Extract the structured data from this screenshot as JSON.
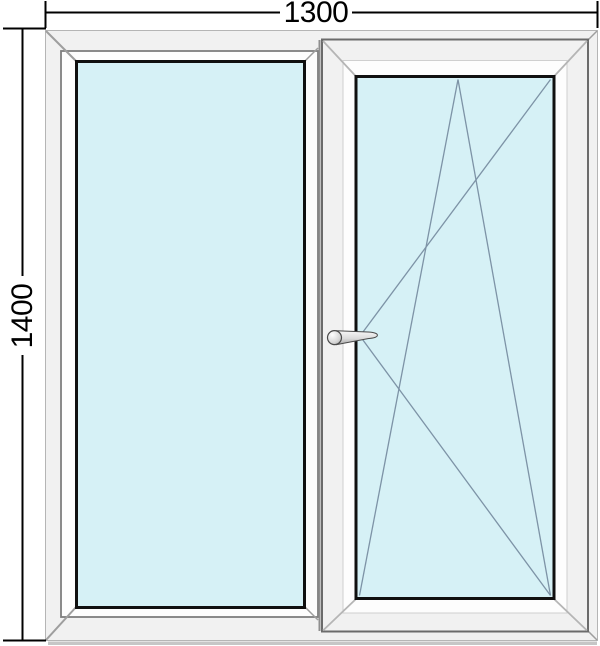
{
  "figure": {
    "type": "window-technical-drawing",
    "description": "Two-section PVC window: left fixed glazed pane, right tilt-and-turn sash with handle",
    "dimensions": {
      "width_label": "1300",
      "height_label": "1400"
    },
    "panels": [
      {
        "name": "left-pane",
        "glazing": "fixed",
        "opening": "none"
      },
      {
        "name": "right-pane",
        "glazing": "sash",
        "opening": "tilt-and-turn",
        "handle_side": "left"
      }
    ],
    "colors": {
      "background": "#ffffff",
      "glass": "#d6f1f6",
      "frame_face": "#f1f1f1",
      "frame_edge": "#b5b5b5",
      "sash_edge": "#6b6b6b",
      "profile_line": "#7e7e7e",
      "glazing_bead": "#101010",
      "opening_line": "#7d93a6",
      "dimension_line": "#000000",
      "handle_fill": "#d9d9d9",
      "handle_stroke": "#4a4a4a"
    }
  }
}
